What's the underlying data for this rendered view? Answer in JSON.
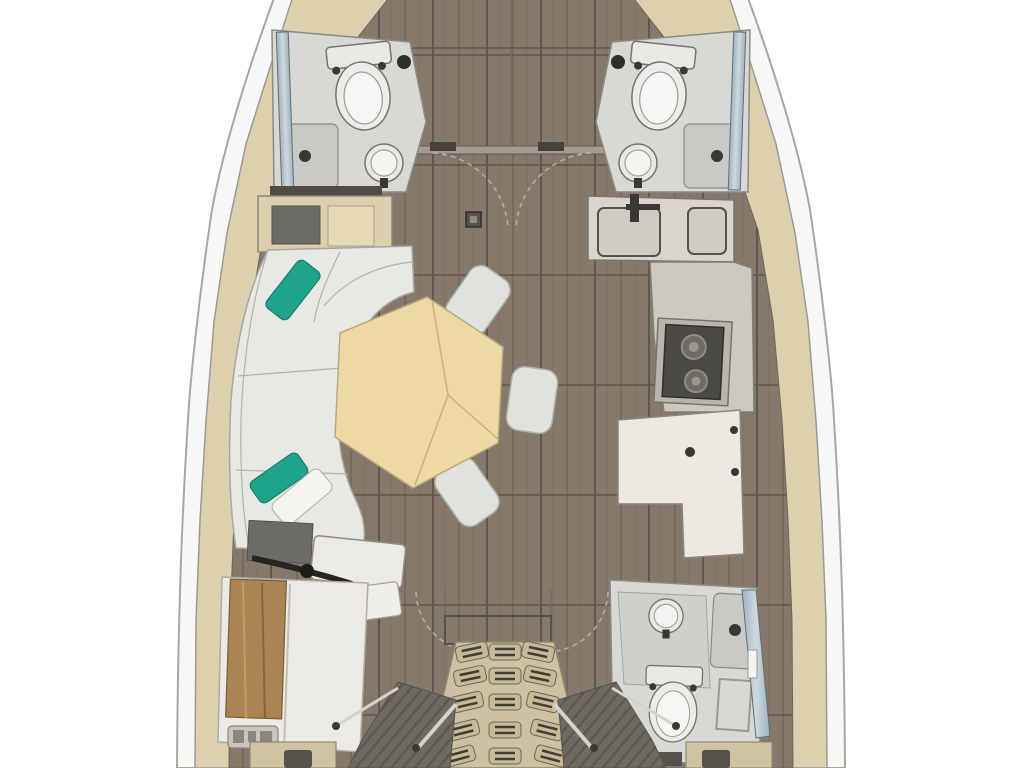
{
  "diagram": {
    "type": "sailboat-interior-floor-plan",
    "orientation": "bow-up",
    "areas": [
      {
        "id": "forward-cabin",
        "fixtures": [
          "wood-sole",
          "door-swing-arcs",
          "mast-step"
        ]
      },
      {
        "id": "forward-head-port",
        "fixtures": [
          "toilet",
          "round-sink",
          "shower-pan",
          "hull-window"
        ]
      },
      {
        "id": "forward-head-starboard",
        "fixtures": [
          "toilet",
          "round-sink",
          "shower-pan",
          "hull-window"
        ]
      },
      {
        "id": "salon",
        "fixtures": [
          "l-shaped-sofa",
          "teal-pillows",
          "white-pillow",
          "hexagonal-table",
          "stools",
          "storage-cabinet"
        ]
      },
      {
        "id": "galley",
        "fixtures": [
          "double-sink",
          "faucet",
          "two-burner-stove",
          "counter"
        ]
      },
      {
        "id": "nav-station",
        "fixtures": [
          "l-shaped-desk",
          "knobs"
        ]
      },
      {
        "id": "aft-cabin-port",
        "fixtures": [
          "double-berth",
          "wood-headboard",
          "vanity-desk",
          "control-panel"
        ]
      },
      {
        "id": "aft-head-starboard",
        "fixtures": [
          "toilet",
          "round-sink",
          "shower-pan",
          "towel-rack",
          "hull-window"
        ]
      },
      {
        "id": "companionway",
        "fixtures": [
          "fan-stairs",
          "tread-pads",
          "handrails",
          "engine-panels"
        ]
      }
    ],
    "counts": {
      "toilets": 3,
      "sinks": 4,
      "stools": 3,
      "stair-rows": 5,
      "teal-pillows": 2
    }
  },
  "palette": {
    "background": "#ffffff",
    "hull": "#f7f7f5",
    "side_deck": "#ddd0ae",
    "floor_wood": "#85796b",
    "floor_line": "#6f6659",
    "head_floor": "#d8d8d4",
    "shower_pan": "#c9c9c5",
    "fixture": "#ececea",
    "fixture_inner": "#f6f6f4",
    "sofa": "#e8e8e5",
    "pillow_teal": "#1fa389",
    "pillow_white": "#f4f4f1",
    "table_wood": "#eed9a4",
    "table_seam": "#c3b183",
    "stool": "#e1e1de",
    "counter": "#d8d5cc",
    "galley_floor": "#ccc9c0",
    "stove": "#4c4a45",
    "nav_desk": "#ece9e2",
    "stairs": "#cdc1a1",
    "tread_pad": "#c6ba98",
    "tread_slot": "#413c34",
    "engine_panel": "#6f6a61",
    "bed_wood": "#aa8453",
    "mattress": "#eceae5",
    "window_glass": "#9fb2bd",
    "dark_fitting": "#3a3834"
  }
}
